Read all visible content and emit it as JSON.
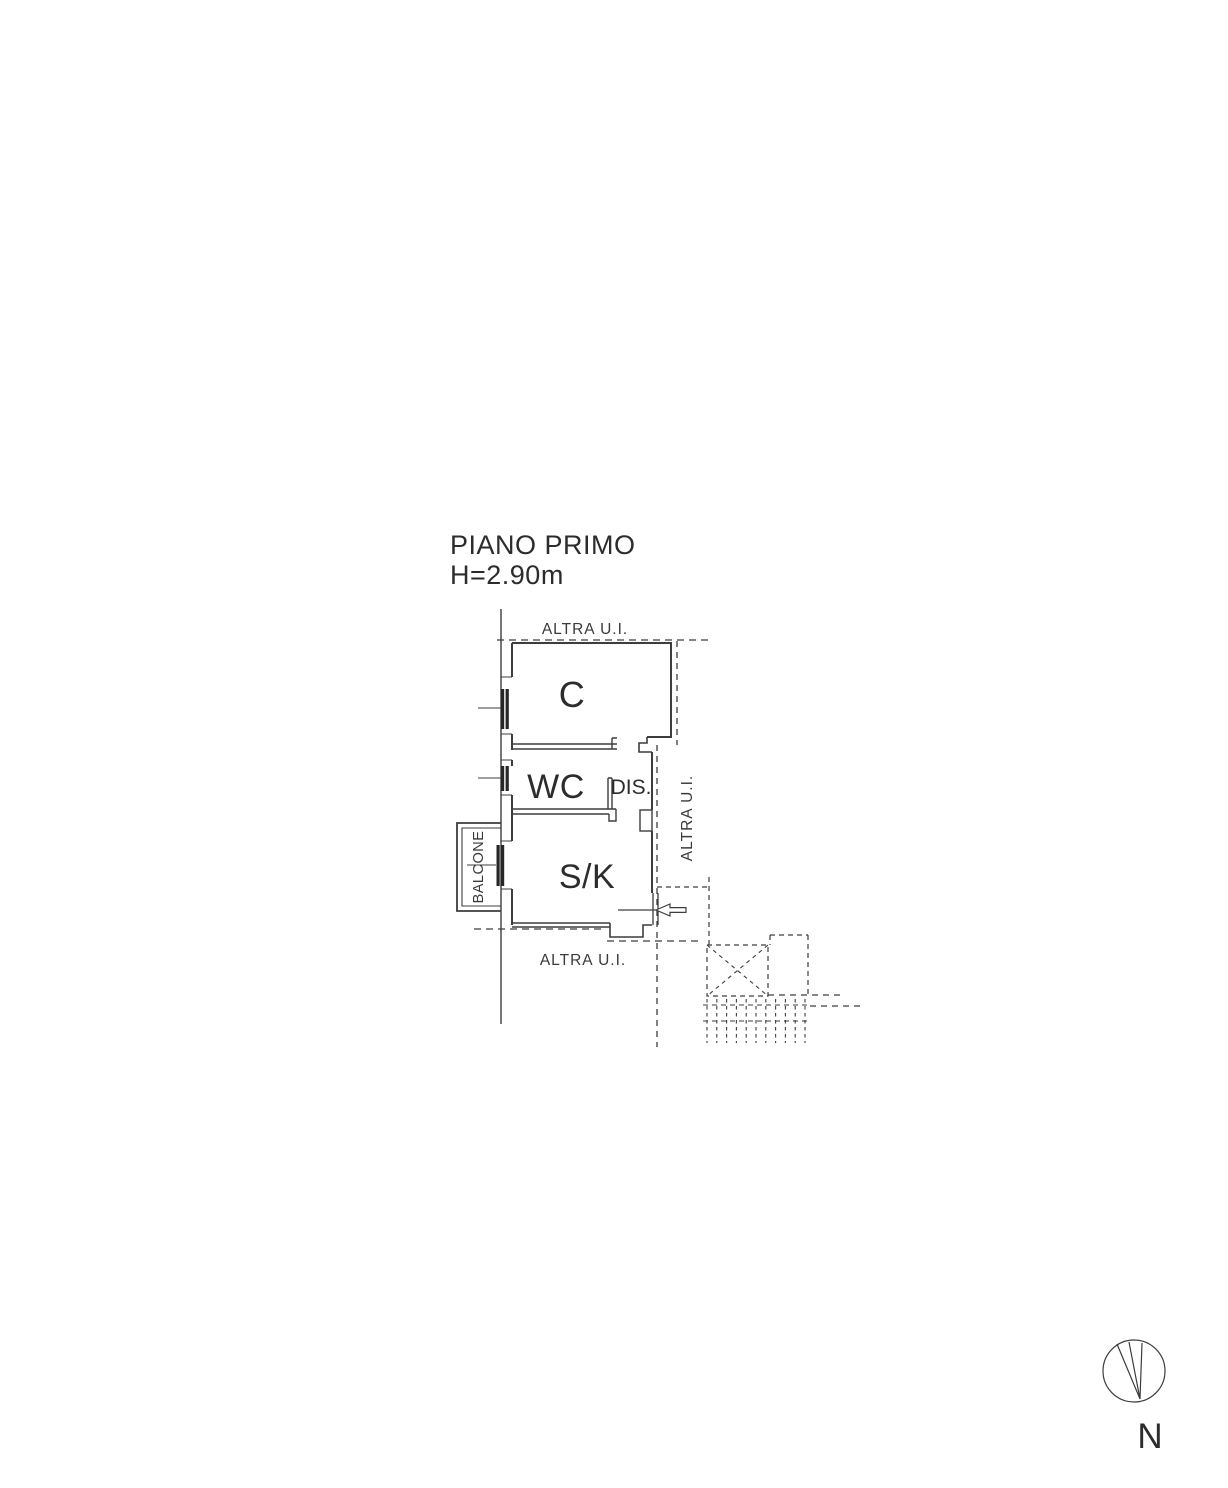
{
  "title": {
    "line1": "PIANO PRIMO",
    "line2": "H=2.90m"
  },
  "plan": {
    "rooms": {
      "c": "C",
      "wc": "WC",
      "dis": "DIS.",
      "sk": "S/K"
    },
    "labels": {
      "altra_ui_top": "ALTRA U.I.",
      "altra_ui_right": "ALTRA U.I.",
      "altra_ui_bottom": "ALTRA U.I.",
      "balcone": "BALCONE"
    }
  },
  "compass": {
    "north_label": "N"
  },
  "colors": {
    "ink": "#3d3d3d",
    "text": "#2c2c2c",
    "background": "#ffffff"
  }
}
